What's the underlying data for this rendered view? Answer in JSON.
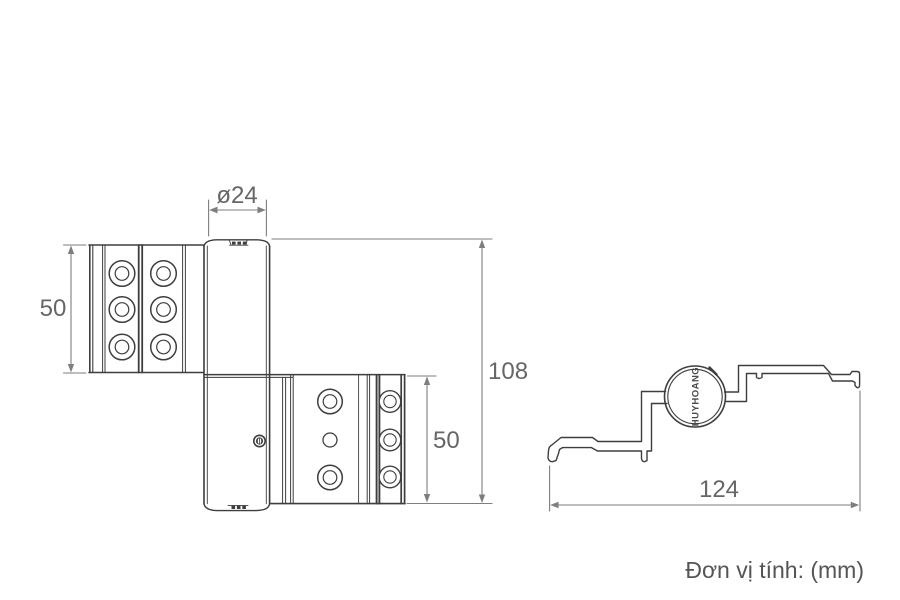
{
  "unit_note": "Đơn vị tính: (mm)",
  "brand": "HUYHOANG",
  "colors": {
    "outline": "#3e3e3e",
    "dimension_line": "#7e7e7e",
    "dimension_text": "#666666",
    "note_text": "#555555",
    "background": "#ffffff"
  },
  "dimensions": {
    "barrel_diameter": "ø24",
    "upper_leaf_height": "50",
    "overall_height": "108",
    "lower_leaf_height": "50",
    "profile_width": "124"
  }
}
